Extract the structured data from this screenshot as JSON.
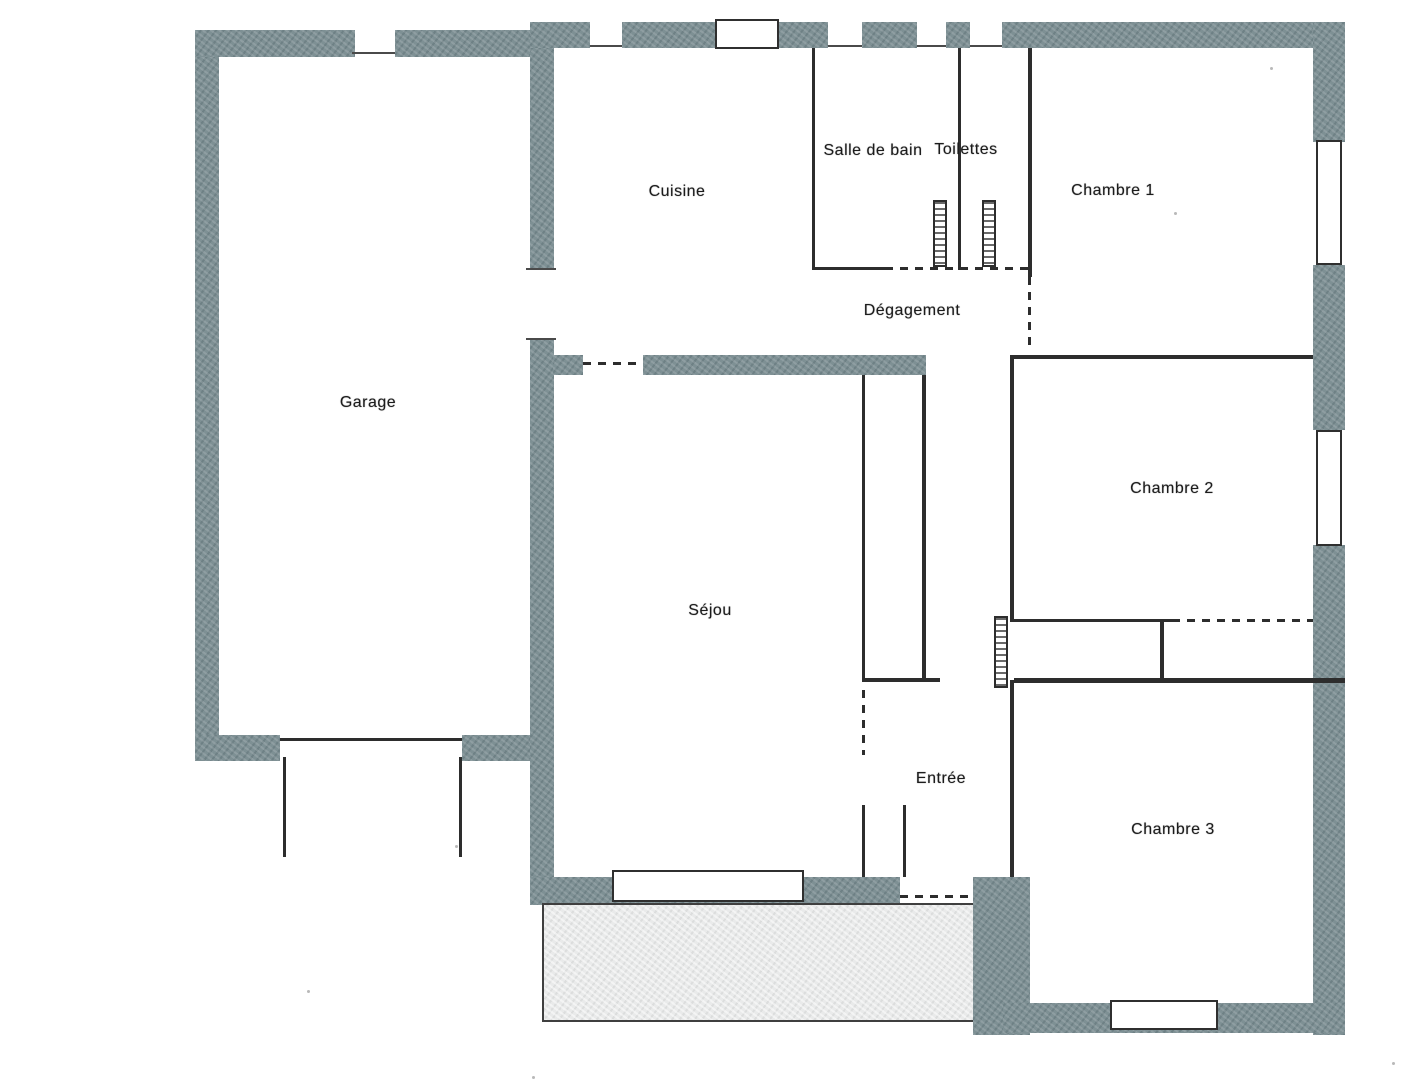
{
  "title": "Plan de maison (floor plan)",
  "colors": {
    "wall": "#7e9094",
    "interior_line": "#2d2d2d",
    "terrace_fill": "#e9eaea",
    "background": "#ffffff",
    "label_text": "#1c1c1c"
  },
  "rooms": [
    {
      "id": "garage",
      "label": "Garage"
    },
    {
      "id": "cuisine",
      "label": "Cuisine"
    },
    {
      "id": "salle-de-bain",
      "label": "Salle de bain"
    },
    {
      "id": "toilettes",
      "label": "Toilettes"
    },
    {
      "id": "chambre-1",
      "label": "Chambre 1"
    },
    {
      "id": "degagement",
      "label": "Dégagement"
    },
    {
      "id": "chambre-2",
      "label": "Chambre 2"
    },
    {
      "id": "sejour",
      "label": "Séjou"
    },
    {
      "id": "entree",
      "label": "Entrée"
    },
    {
      "id": "chambre-3",
      "label": "Chambre 3"
    }
  ]
}
